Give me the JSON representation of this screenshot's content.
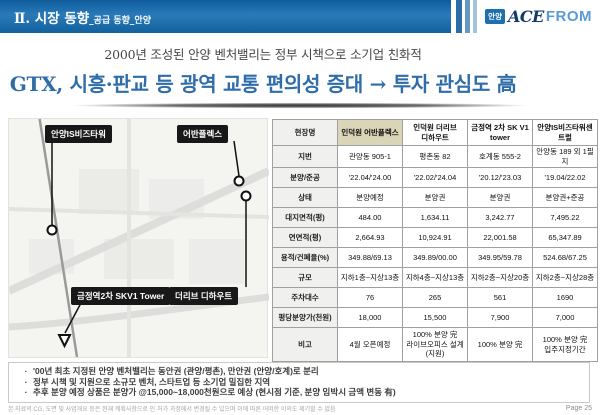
{
  "header": {
    "title": "Ⅱ. 시장 동향",
    "subtitle": "_공급 동향_안양",
    "logo_badge": "안양",
    "logo_ace": "ACE",
    "logo_from": "FROM"
  },
  "headline": {
    "line1": "2000년 조성된 안양 벤처밸리는 정부 시책으로 소기업 친화적",
    "line2": "GTX, 시흥·판교 등 광역 교통 편의성 증대 → 투자 관심도 高"
  },
  "map": {
    "markers": [
      {
        "label": "안양IS비즈타워"
      },
      {
        "label": "어반플렉스"
      },
      {
        "label": "금정역2차 SKV1 Tower"
      },
      {
        "label": "더리브 디하우트"
      }
    ]
  },
  "table": {
    "rows": [
      {
        "label": "현장명",
        "cells": [
          "인덕원 어반플렉스",
          "인덕원 더리브\n디하우트",
          "금정역 2차 SK V1\ntower",
          "안양IS비즈타워센트럴"
        ]
      },
      {
        "label": "지번",
        "cells": [
          "관양동 905-1",
          "평촌동 82",
          "호계동 555-2",
          "안양동 189 외 1필지"
        ]
      },
      {
        "label": "분양/준공",
        "cells": [
          "'22.04/'24.00",
          "'22.02/'24.04",
          "'20.12/'23.03",
          "'19.04/22.02"
        ]
      },
      {
        "label": "상태",
        "cells": [
          "분양예정",
          "분양권",
          "분양권",
          "분양권+준공"
        ]
      },
      {
        "label": "대지면적(평)",
        "cells": [
          "484.00",
          "1,634.11",
          "3,242.77",
          "7,495.22"
        ]
      },
      {
        "label": "연면적(평)",
        "cells": [
          "2,664.93",
          "10,924.91",
          "22,001.58",
          "65,347.89"
        ]
      },
      {
        "label": "용적/건폐율(%)",
        "cells": [
          "349.88/69.13",
          "349.89/00.00",
          "349.95/59.78",
          "524.68/67.25"
        ]
      },
      {
        "label": "규모",
        "cells": [
          "지하1층~지상13층",
          "지하4층~지상13층",
          "지하2층~지상20층",
          "지하2층~지상28층"
        ]
      },
      {
        "label": "주차대수",
        "cells": [
          "76",
          "265",
          "561",
          "1690"
        ]
      },
      {
        "label": "평당분양가(천원)",
        "cells": [
          "18,000",
          "15,500",
          "7,900",
          "7,000"
        ]
      },
      {
        "label": "비고",
        "cells": [
          "4월 오픈예정",
          "100% 분양 完\n라이브오피스 설계(지원)",
          "100% 분양 完",
          "100% 분양 完\n입주지정기간"
        ]
      }
    ]
  },
  "notes": {
    "bullet": "·",
    "items": [
      "'00년 최초 지정된 안양 벤처밸리는 동안권 (관양/평촌), 만안권 (안양/호계)로 분리",
      "정부 시책 및 지원으로 소규모 벤처, 스타트업 등 소기업 밀집한 지역",
      "추후 분양 예정 상품은 분양가 @15,000~18,000천원으로 예상 (현시점 기준, 분양 임박시 금액 변동 有)"
    ]
  },
  "footer": {
    "disclaimer": "본 자료의 CG, 도면 및 사업개요 등은 현재 계획사항으로 인·허가 과정에서 변경될 수 있으며 이에 따른 어떠한 이의도 제기할 수 없음",
    "page": "Page 25"
  },
  "colors": {
    "header_blue": "#1668a7",
    "headline_blue": "#2f6da8",
    "table_highlight": "#d9d5b6",
    "marker_box": "#181818"
  }
}
